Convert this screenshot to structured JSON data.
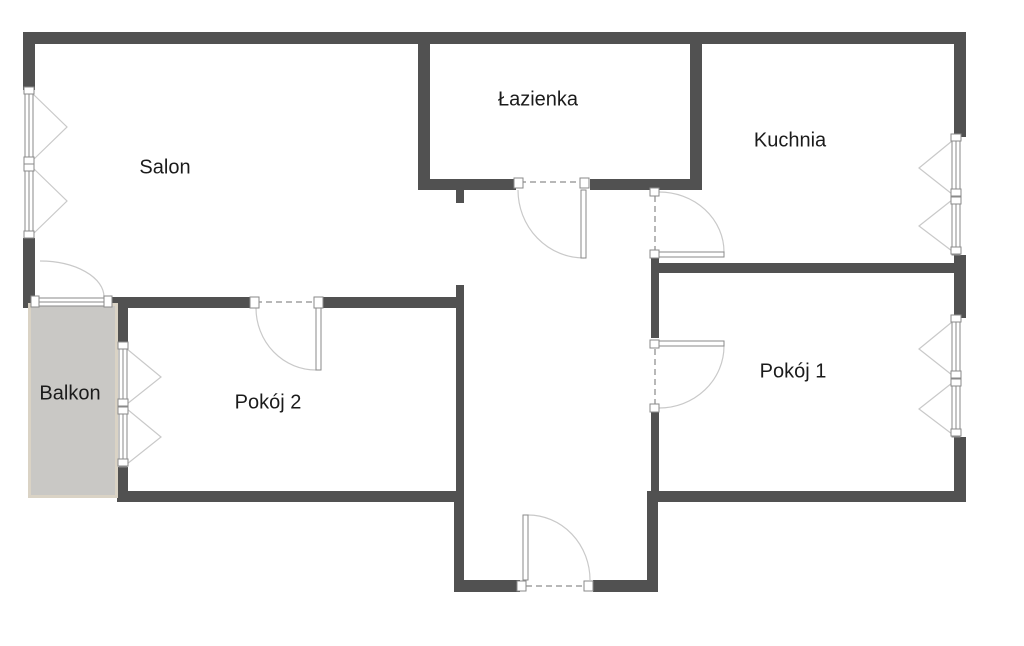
{
  "plan": {
    "type": "apartment-floor-plan",
    "rooms": {
      "salon": "Salon",
      "lazienka": "Łazienka",
      "kuchnia": "Kuchnia",
      "balkon": "Balkon",
      "pokoj2": "Pokój 2",
      "pokoj1": "Pokój 1"
    },
    "colors": {
      "wall": "#515151",
      "balcony_fill": "#c9c8c5",
      "balcony_border": "#dad3c5",
      "frame_stroke": "#8a8a8a",
      "swing_line": "#c9c9c9",
      "dash_line": "#a0a0a0",
      "label_text": "#1b1b1b",
      "background": "#ffffff"
    }
  }
}
